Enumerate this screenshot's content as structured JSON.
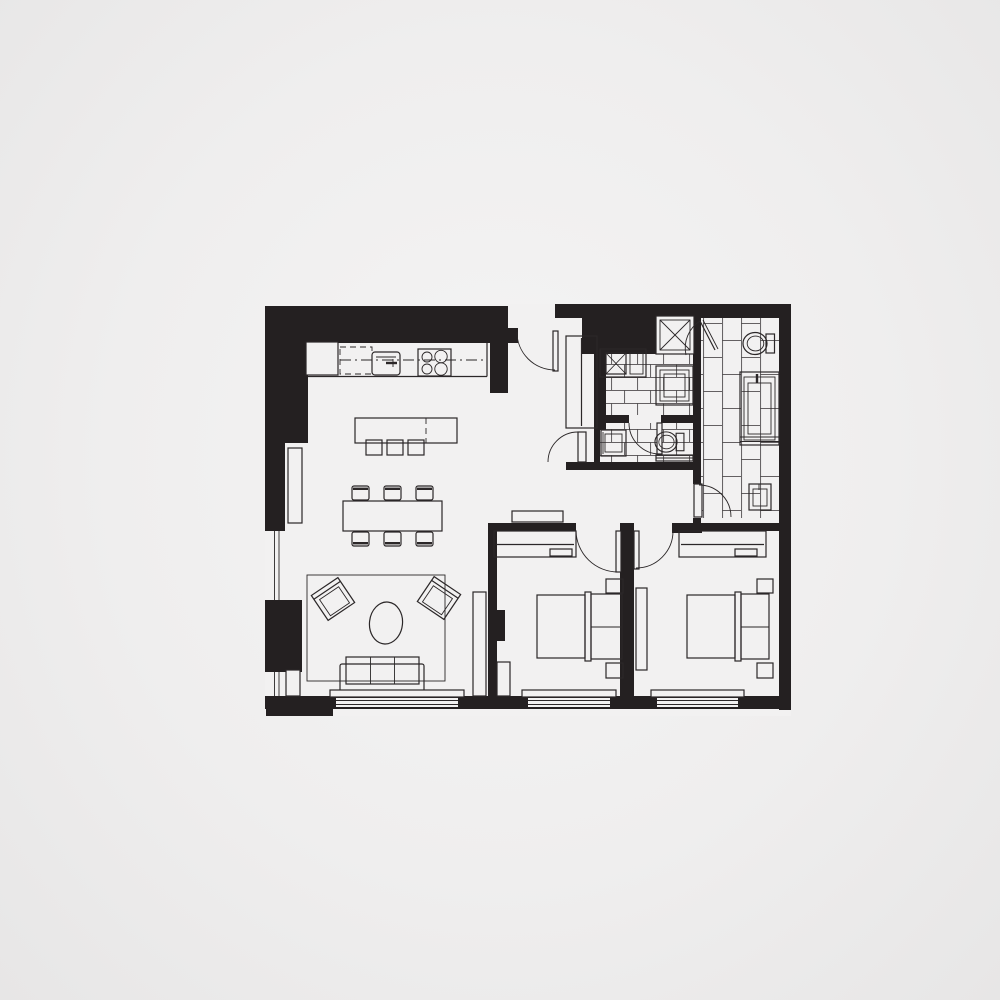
{
  "meta": {
    "type": "architectural-floor-plan",
    "description": "Top-down black-and-white floor plan of a two-bedroom, two-and-a-half-bath apartment on a light gray page. Thick black walls, line-drawn furniture, hatched closets and tiled bathroom floors. No text labels are visible in the drawing.",
    "visible_text": ""
  },
  "colors": {
    "wall": "#242021",
    "line": "#2b2728",
    "tile_line": "#4f4c4d",
    "floor": "#f2f1f1",
    "background_center": "#f5f4f4",
    "background_edge": "#e7e6e6"
  },
  "rooms": {
    "kitchen": {
      "name": "kitchen",
      "features": [
        "refrigerator",
        "counter-run",
        "dashed-base-cabinet",
        "kitchen-sink-with-faucet",
        "cooktop-4-burners",
        "island-with-dashed-split",
        "bar-stools"
      ],
      "bar_stool_count": 3,
      "burner_count": 4
    },
    "dining-area": {
      "name": "dining-area",
      "features": [
        "dining-table",
        "dining-chairs",
        "sideboard-cabinet"
      ],
      "chair_count": 6
    },
    "living-room": {
      "name": "living-room",
      "features": [
        "area-rug",
        "accent-armchairs",
        "oval-coffee-table",
        "three-seat-sofa",
        "media-console",
        "fireplace-column",
        "side-windows",
        "bottom-window"
      ],
      "armchair_count": 2,
      "sofa_seats": 3
    },
    "entry-hall": {
      "name": "entry-hall",
      "features": [
        "front-door-swing",
        "coat-closet-hatched",
        "powder-vestibule-door"
      ]
    },
    "main-bathroom": {
      "name": "main-bathroom",
      "features": [
        "brick-tiled-floor",
        "vanity-sink-x-symbol",
        "square-shower-pan-nested",
        "service-shaft-x-square",
        "glass-shower-door"
      ]
    },
    "powder-room": {
      "name": "powder-room",
      "features": [
        "brick-tiled-floor",
        "toilet",
        "small-vanity-sink",
        "towel-bar",
        "door-swing"
      ]
    },
    "master-bathroom": {
      "name": "master-bathroom",
      "features": [
        "vertical-tiled-floor",
        "toilet",
        "long-vanity-with-faucet",
        "square-wash-basin",
        "door-swing"
      ]
    },
    "corridor": {
      "name": "corridor",
      "features": [
        "console-shelf"
      ]
    },
    "bedroom-1": {
      "name": "bedroom-1",
      "features": [
        "hatched-wardrobe",
        "door-swing",
        "double-bed-with-headboard",
        "pillow-panel",
        "nightstands",
        "dresser",
        "bottom-window",
        "wall-column"
      ],
      "nightstand_count": 2
    },
    "bedroom-2": {
      "name": "bedroom-2",
      "features": [
        "hatched-wardrobe",
        "door-swing",
        "double-bed-with-headboard",
        "pillow-panel",
        "nightstands",
        "tall-cabinet",
        "bottom-window"
      ],
      "nightstand_count": 2
    }
  },
  "window_count": 5,
  "door_swing_count": 7
}
